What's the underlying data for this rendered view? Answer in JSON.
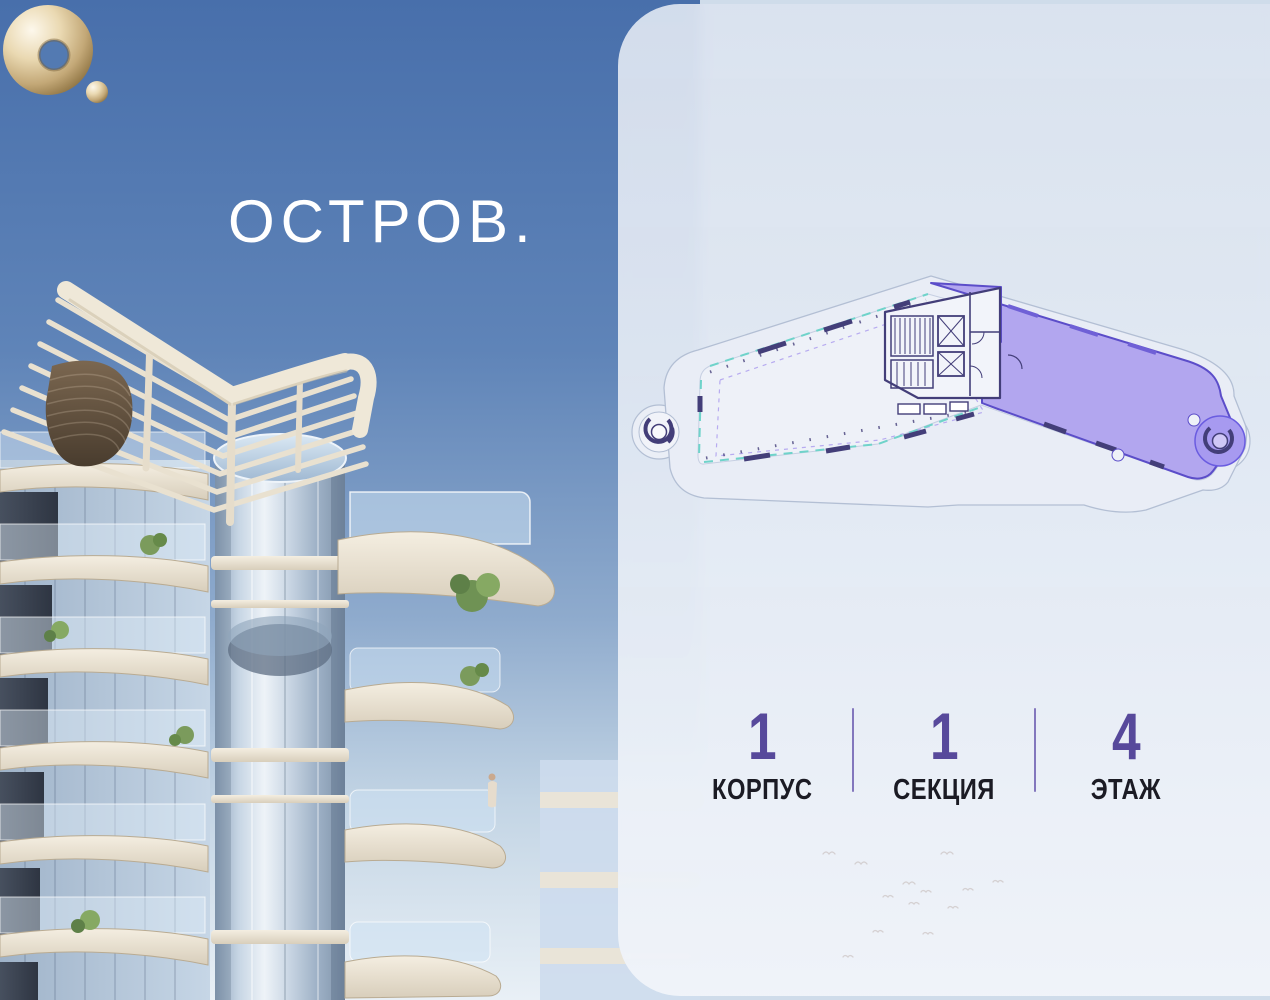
{
  "brand": {
    "logo_text": "ОСТРОВ.",
    "logo_icon": "gold-torus-with-dot"
  },
  "panel": {
    "floorplan": {
      "description": "building footprint plan with highlighted unit",
      "highlighted_unit_selected": true,
      "unit_fill_color": "#b2a6ef",
      "unit_stroke_color": "#5b4dc9"
    },
    "info": {
      "items": [
        {
          "value": "1",
          "label": "КОРПУС"
        },
        {
          "value": "1",
          "label": "СЕКЦИЯ"
        },
        {
          "value": "4",
          "label": "ЭТАЖ"
        }
      ]
    }
  },
  "colors": {
    "accent": "#57499b",
    "label": "#1b1b24",
    "gold": "#cbb58a",
    "sky_top": "#4a70ac",
    "panel_bg": "#e2e9f3"
  }
}
